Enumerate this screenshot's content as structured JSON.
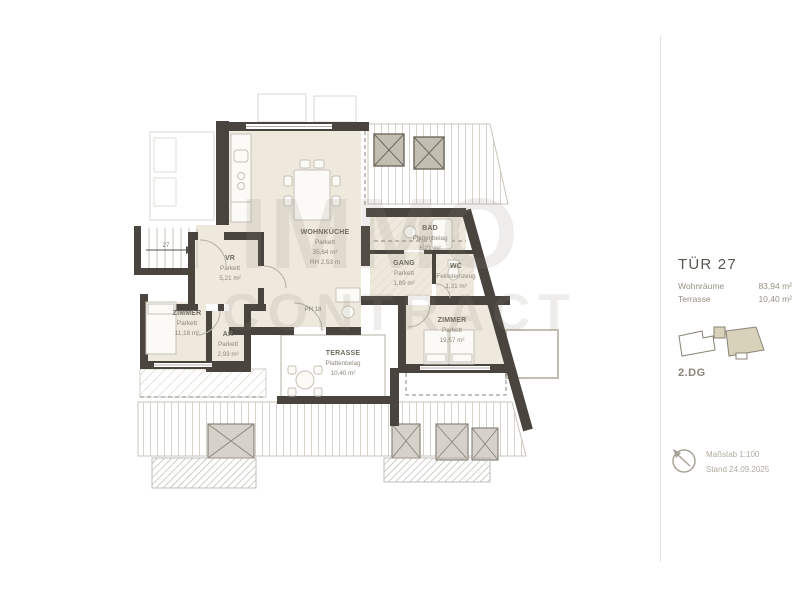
{
  "panel": {
    "title": "TÜR 27",
    "summary": [
      {
        "label": "Wohnräume",
        "value": "83,94 m²"
      },
      {
        "label": "Terrasse",
        "value": "10,40 m²"
      }
    ],
    "floor": "2.DG",
    "scale": "Maßstab 1:100",
    "date": "Stand 24.09.2025",
    "icons": {
      "compass": "north-arrow-icon",
      "minimap": "site-plan-locator"
    }
  },
  "watermark": {
    "line1": "IMMO",
    "line2": "CONTRACT"
  },
  "plan": {
    "rooms": [
      {
        "name": "WOHNKÜCHE",
        "surface": "Parkett",
        "area": "35,64 m²",
        "extra": "RH 2,53 m"
      },
      {
        "name": "VR",
        "surface": "Parkett",
        "area": "5,21 m²"
      },
      {
        "name": "ZIMMER",
        "surface": "Parkett",
        "area": "11,18 m²"
      },
      {
        "name": "AR",
        "surface": "Parkett",
        "area": "2,93 m²"
      },
      {
        "name": "GANG",
        "surface": "Parkett",
        "area": "1,89 m²"
      },
      {
        "name": "BAD",
        "surface": "Plattenbelag",
        "area": "6,21 m²"
      },
      {
        "name": "WC",
        "surface": "Feinsteinzeug",
        "area": "1,31 m²"
      },
      {
        "name": "ZIMMER",
        "surface": "Parkett",
        "area": "19,57 m²"
      },
      {
        "name": "TERASSE",
        "surface": "Plattenbelag",
        "area": "10,40 m²"
      }
    ],
    "annotations": {
      "door_label": "PH 18",
      "stair_label": "27"
    }
  },
  "colors": {
    "wall": "#49443d",
    "room_fill": "#eee9dc",
    "highlight": "#d9d2ba",
    "muted_line": "#c9c4ba",
    "text_dark": "#5a554e",
    "text_muted": "#979184"
  }
}
